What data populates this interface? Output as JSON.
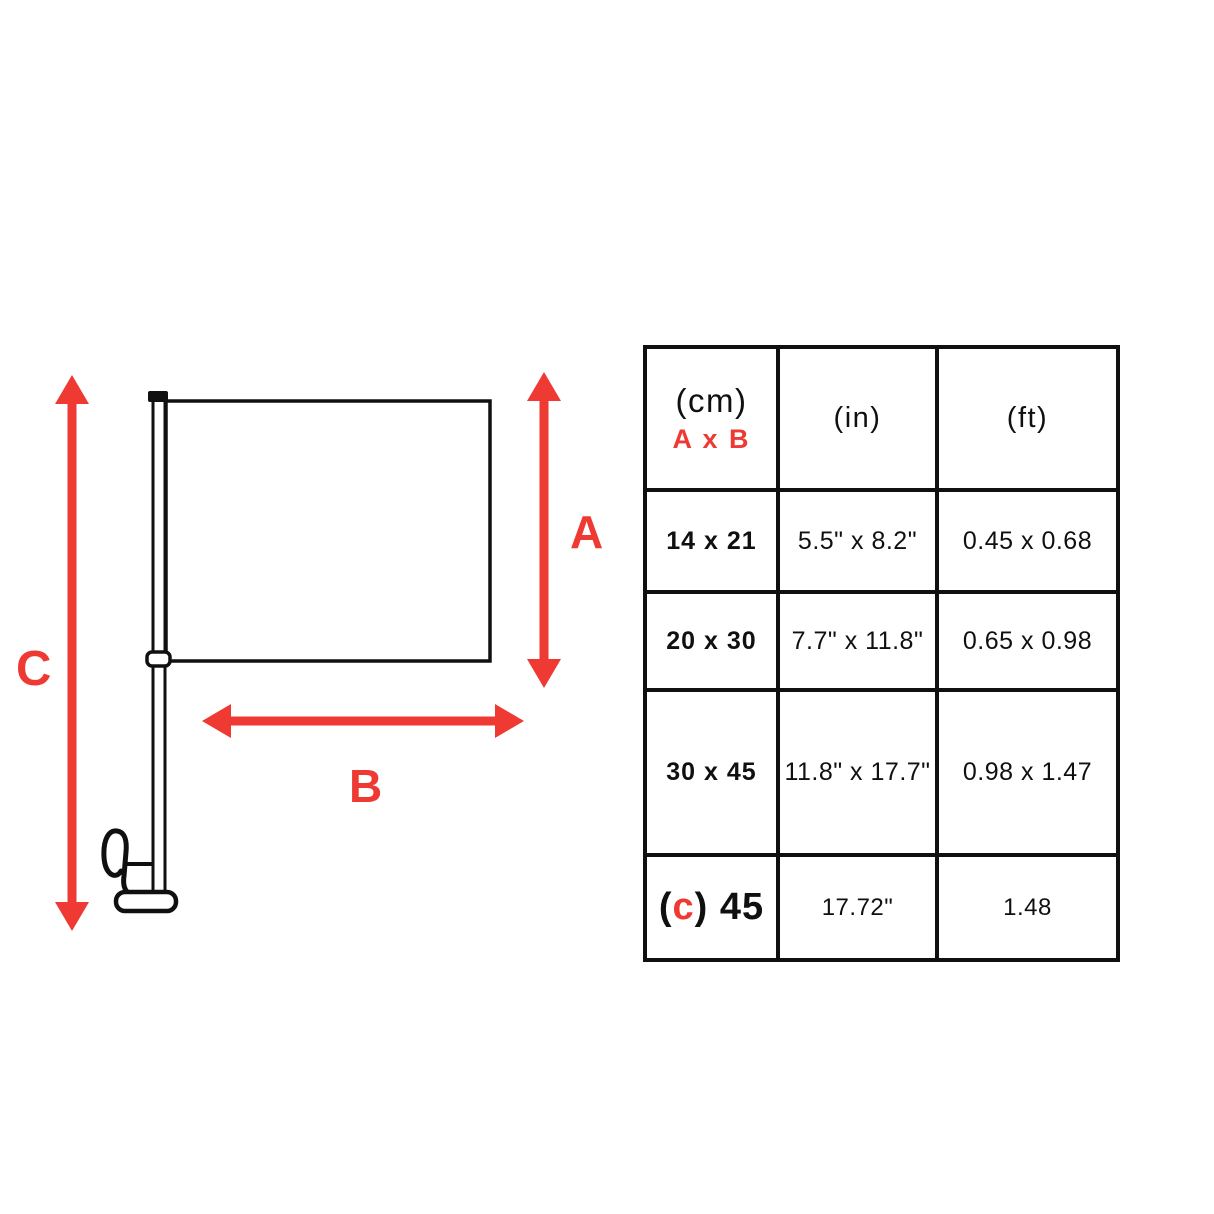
{
  "colors": {
    "red": "#ee3a33",
    "ink": "#101010"
  },
  "diagram": {
    "icon": "car-window-flag-with-pole-and-clip",
    "labels": {
      "a": "A",
      "b": "B",
      "c": "C"
    }
  },
  "table": {
    "header": {
      "cm_unit": "(cm)",
      "cm_formula": "A x B",
      "in_unit": "(in)",
      "ft_unit": "(ft)"
    },
    "rows": [
      {
        "cm": "14 x 21",
        "inches": "5.5\" x 8.2\"",
        "feet": "0.45 x 0.68"
      },
      {
        "cm": "20 x 30",
        "inches": "7.7\" x 11.8\"",
        "feet": "0.65 x 0.98"
      },
      {
        "cm": "30 x 45",
        "inches": "11.8\" x 17.7\"",
        "feet": "0.98 x 1.47"
      },
      {
        "cm_parts": {
          "open": "(",
          "c": "c",
          "rest": ") 45"
        },
        "inches": "17.72\"",
        "feet": "1.48"
      }
    ]
  }
}
